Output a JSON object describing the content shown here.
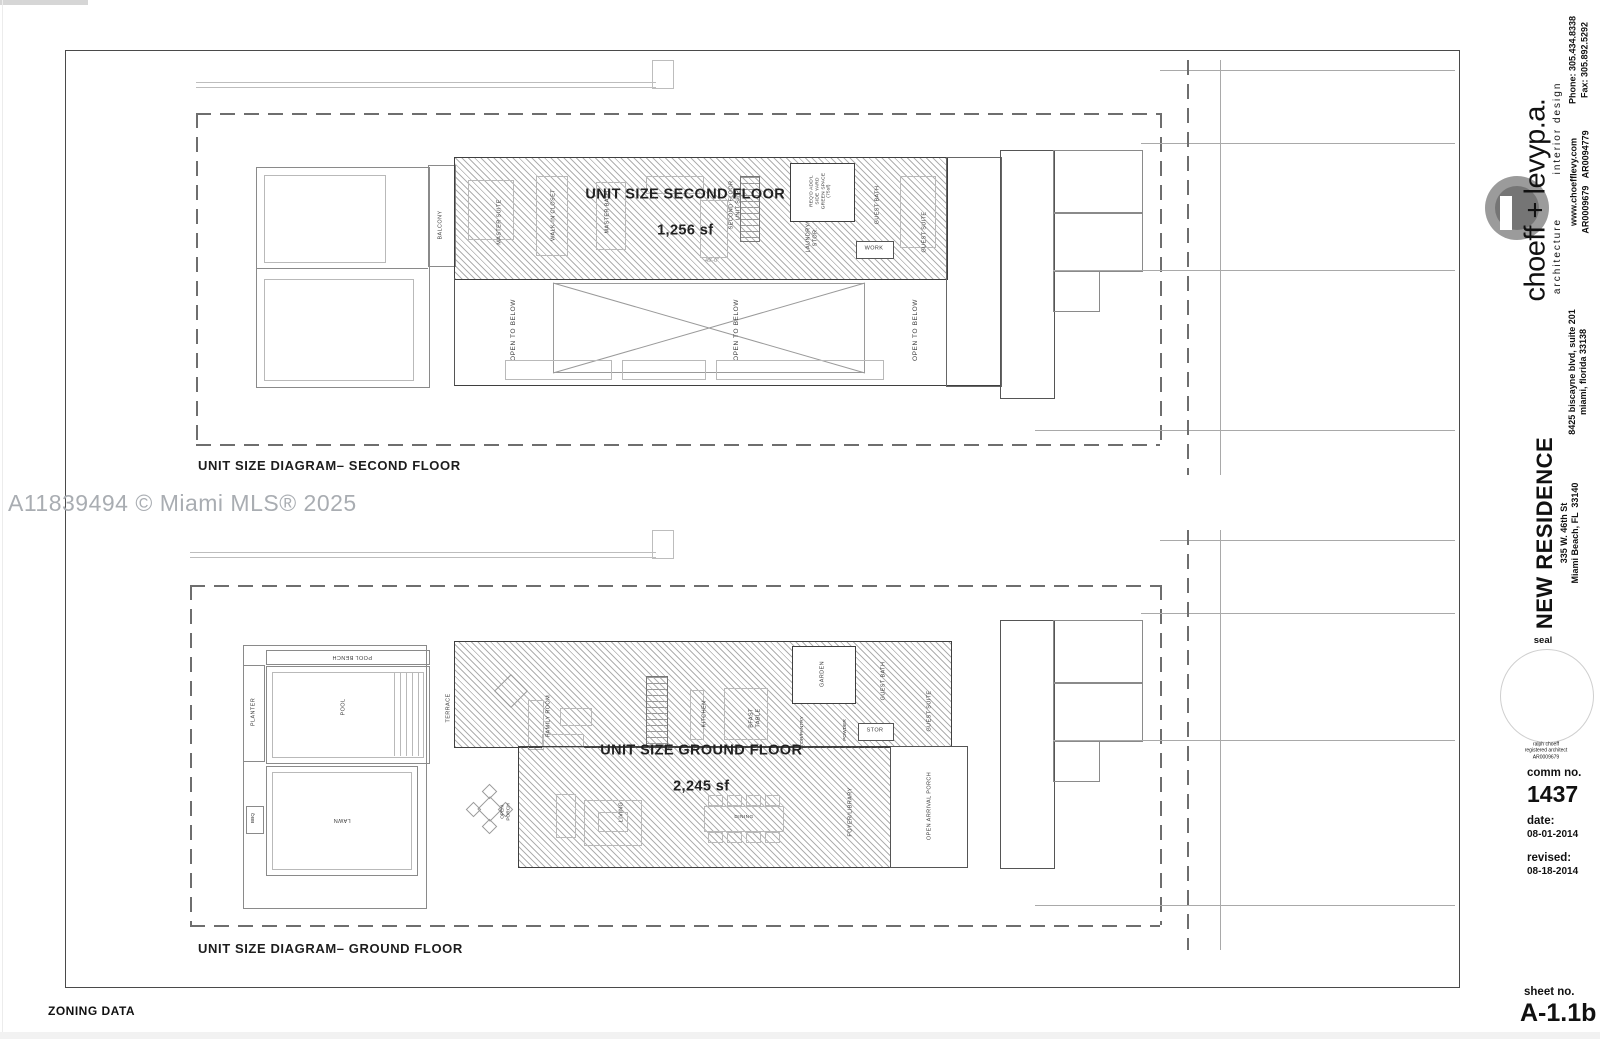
{
  "page": {
    "watermark": "A11839494 © Miami MLS® 2025",
    "zoning_label": "ZONING DATA"
  },
  "second_floor": {
    "caption": "UNIT SIZE DIAGRAM– SECOND FLOOR",
    "unit_title": "UNIT SIZE SECOND FLOOR",
    "unit_area": "1,256 sf",
    "labels": {
      "balcony": "BALCONY",
      "master_suite": "MASTER SUITE",
      "walkin_closet": "WALK-IN CLOSET",
      "master_bath": "MASTER BATH",
      "stair_note": "SECOND FLOOR\nUNIT SIZE",
      "green_space": "REQ'D ADD'L\nSIDE YARD\nGREEN SPACE\n(75sf)",
      "laundry": "LAUNDRY/\nSTOR.",
      "guest_bath": "GUEST BATH",
      "work": "WORK",
      "guest_suite": "GUEST SUITE",
      "dimension": "49'-0\"",
      "open_below_1": "OPEN TO BELOW",
      "open_below_2": "OPEN TO BELOW",
      "open_below_3": "OPEN TO BELOW"
    }
  },
  "ground_floor": {
    "caption": "UNIT SIZE DIAGRAM– GROUND FLOOR",
    "unit_title": "UNIT SIZE GROUND FLOOR",
    "unit_area": "2,245 sf",
    "labels": {
      "planter": "PLANTER",
      "pool_bench": "POOL BENCH",
      "pool": "POOL",
      "bbq": "BBQ",
      "lawn": "LAWN",
      "terrace": "TERRACE",
      "open_porch": "OPEN\nPORCH",
      "family_room": "FAMILY ROOM",
      "kitchen": "KITCHEN",
      "bfast_table": "BFAST\nTABLE",
      "garden": "GARDEN",
      "stor_pantry": "STOR/PANTRY",
      "powder": "POWDER",
      "stor": "STOR",
      "guest_bath": "GUEST BATH",
      "guest_suite": "GUEST SUITE",
      "living": "LIVING",
      "dining": "DINING",
      "foyer_library": "FOYER/LIBRARY",
      "arrival_porch": "OPEN ARRIVAL PORCH"
    }
  },
  "title_block": {
    "firm_name": "choeff + levyp.a.",
    "tag_architecture": "architecture",
    "tag_interior": "interior design",
    "phone": "Phone: 305.434.8338",
    "fax": "Fax: 305.892.5292",
    "website": "www.choefflevy.com",
    "licenses": "AR0009679   AR0094779",
    "address": "8425 biscayne blvd, suite 201\nmiami, florida 33138",
    "project_name": "NEW RESIDENCE",
    "project_address": "335 W. 46th St\nMiami Beach, FL  33140",
    "seal_label": "seal",
    "seal_note": "ralph choeff\nregistered architect\nAR0009679",
    "comm_label": "comm no.",
    "comm_value": "1437",
    "date_label": "date:",
    "date_value": "08-01-2014",
    "revised_label": "revised:",
    "revised_value": "08-18-2014",
    "sheet_label": "sheet no.",
    "sheet_value": "A-1.1b"
  }
}
